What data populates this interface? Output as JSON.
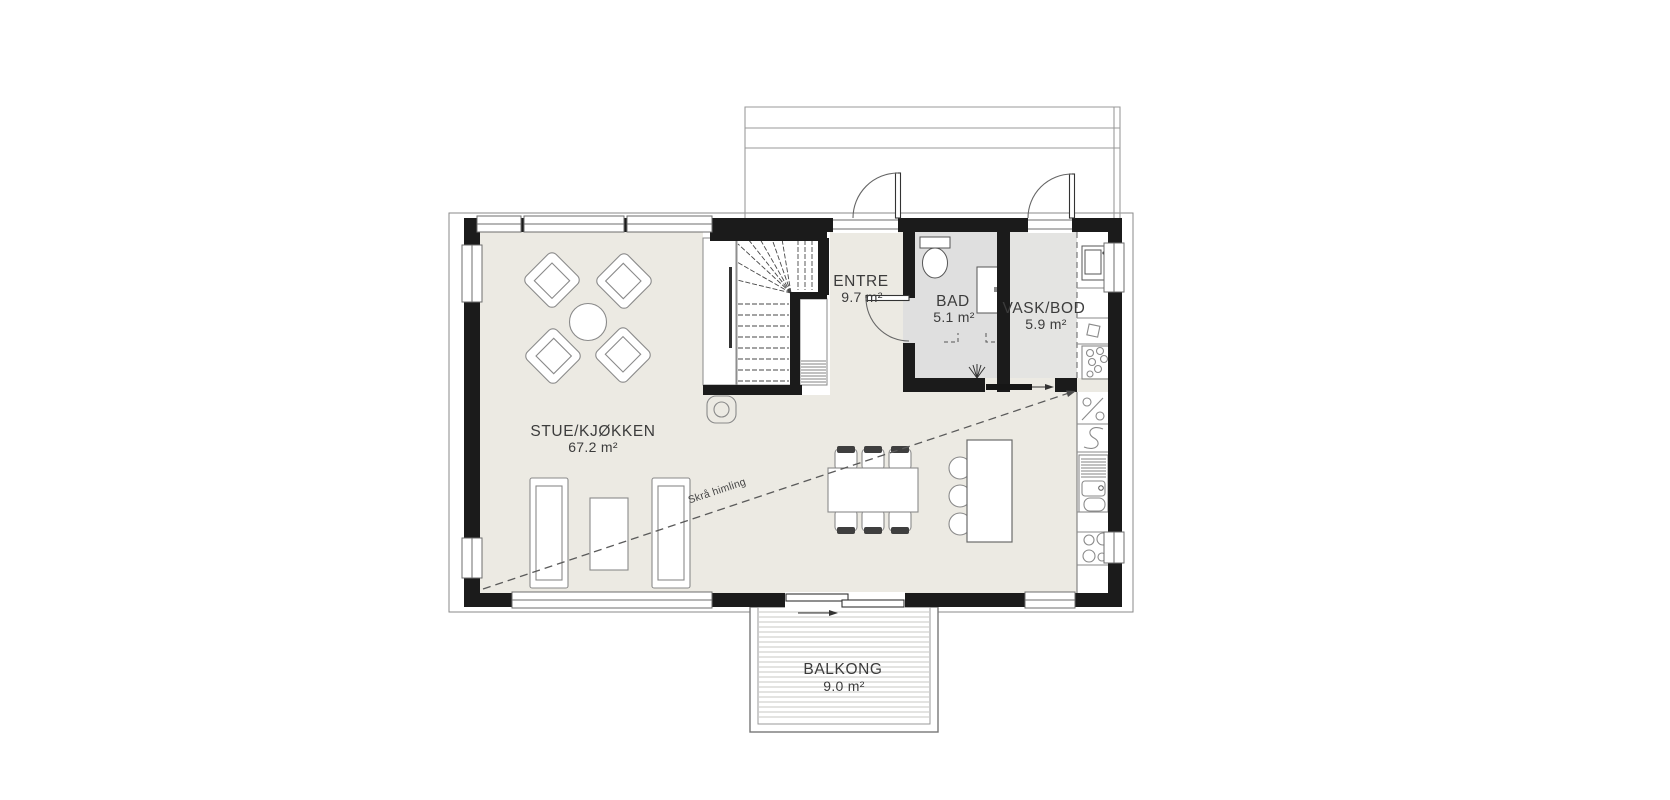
{
  "plan": {
    "rooms": [
      {
        "id": "stue-kjokken",
        "name": "STUE/KJØKKEN",
        "area": "67.2 m²"
      },
      {
        "id": "entre",
        "name": "ENTRE",
        "area": "9.7 m²"
      },
      {
        "id": "bad",
        "name": "BAD",
        "area": "5.1 m²"
      },
      {
        "id": "vask-bod",
        "name": "VASK/BOD",
        "area": "5.9 m²"
      },
      {
        "id": "balkong",
        "name": "BALKONG",
        "area": "9.0 m²"
      }
    ],
    "annotations": {
      "sloped_ceiling": "Skrå himling"
    },
    "colors": {
      "wall": "#1b1b1b",
      "floor_main": "#eceae3",
      "floor_bad": "#dfdfdf",
      "floor_vask": "#e4e4e2",
      "outline": "#8a8a8a",
      "background": "#ffffff"
    }
  }
}
